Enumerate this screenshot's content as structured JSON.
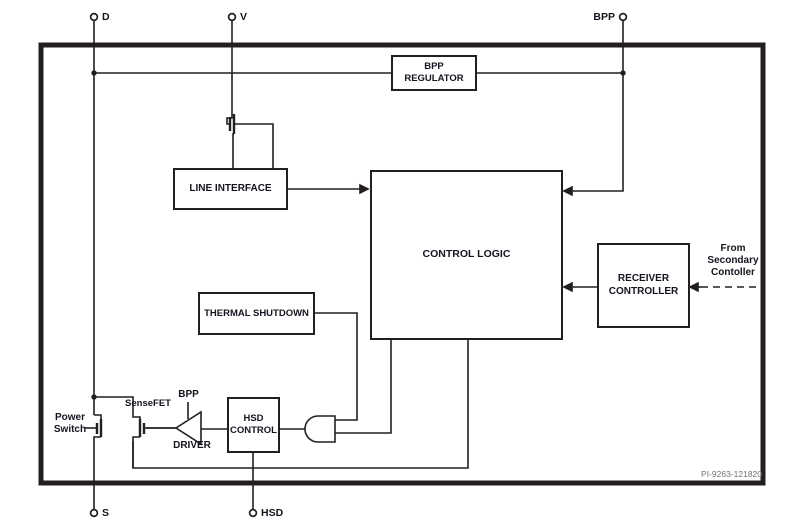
{
  "meta": {
    "part_code": "PI-9263-121820"
  },
  "colors": {
    "line": "#231f20",
    "text": "#17131f",
    "code": "#707070",
    "background": "#ffffff"
  },
  "pins": {
    "d": "D",
    "v": "V",
    "bpp": "BPP",
    "s": "S",
    "hsd": "HSD"
  },
  "blocks": {
    "bpp_regulator": "BPP\nREGULATOR",
    "line_interface": "LINE INTERFACE",
    "control_logic": "CONTROL LOGIC",
    "thermal_shutdown": "THERMAL SHUTDOWN",
    "receiver_controller": "RECEIVER\nCONTROLLER",
    "hsd_control": "HSD\nCONTROL"
  },
  "labels": {
    "power_switch": "Power\nSwitch",
    "sensefet": "SenseFET",
    "driver_bpp": "BPP",
    "driver": "DRIVER",
    "from_secondary": "From\nSecondary\nContoller"
  }
}
